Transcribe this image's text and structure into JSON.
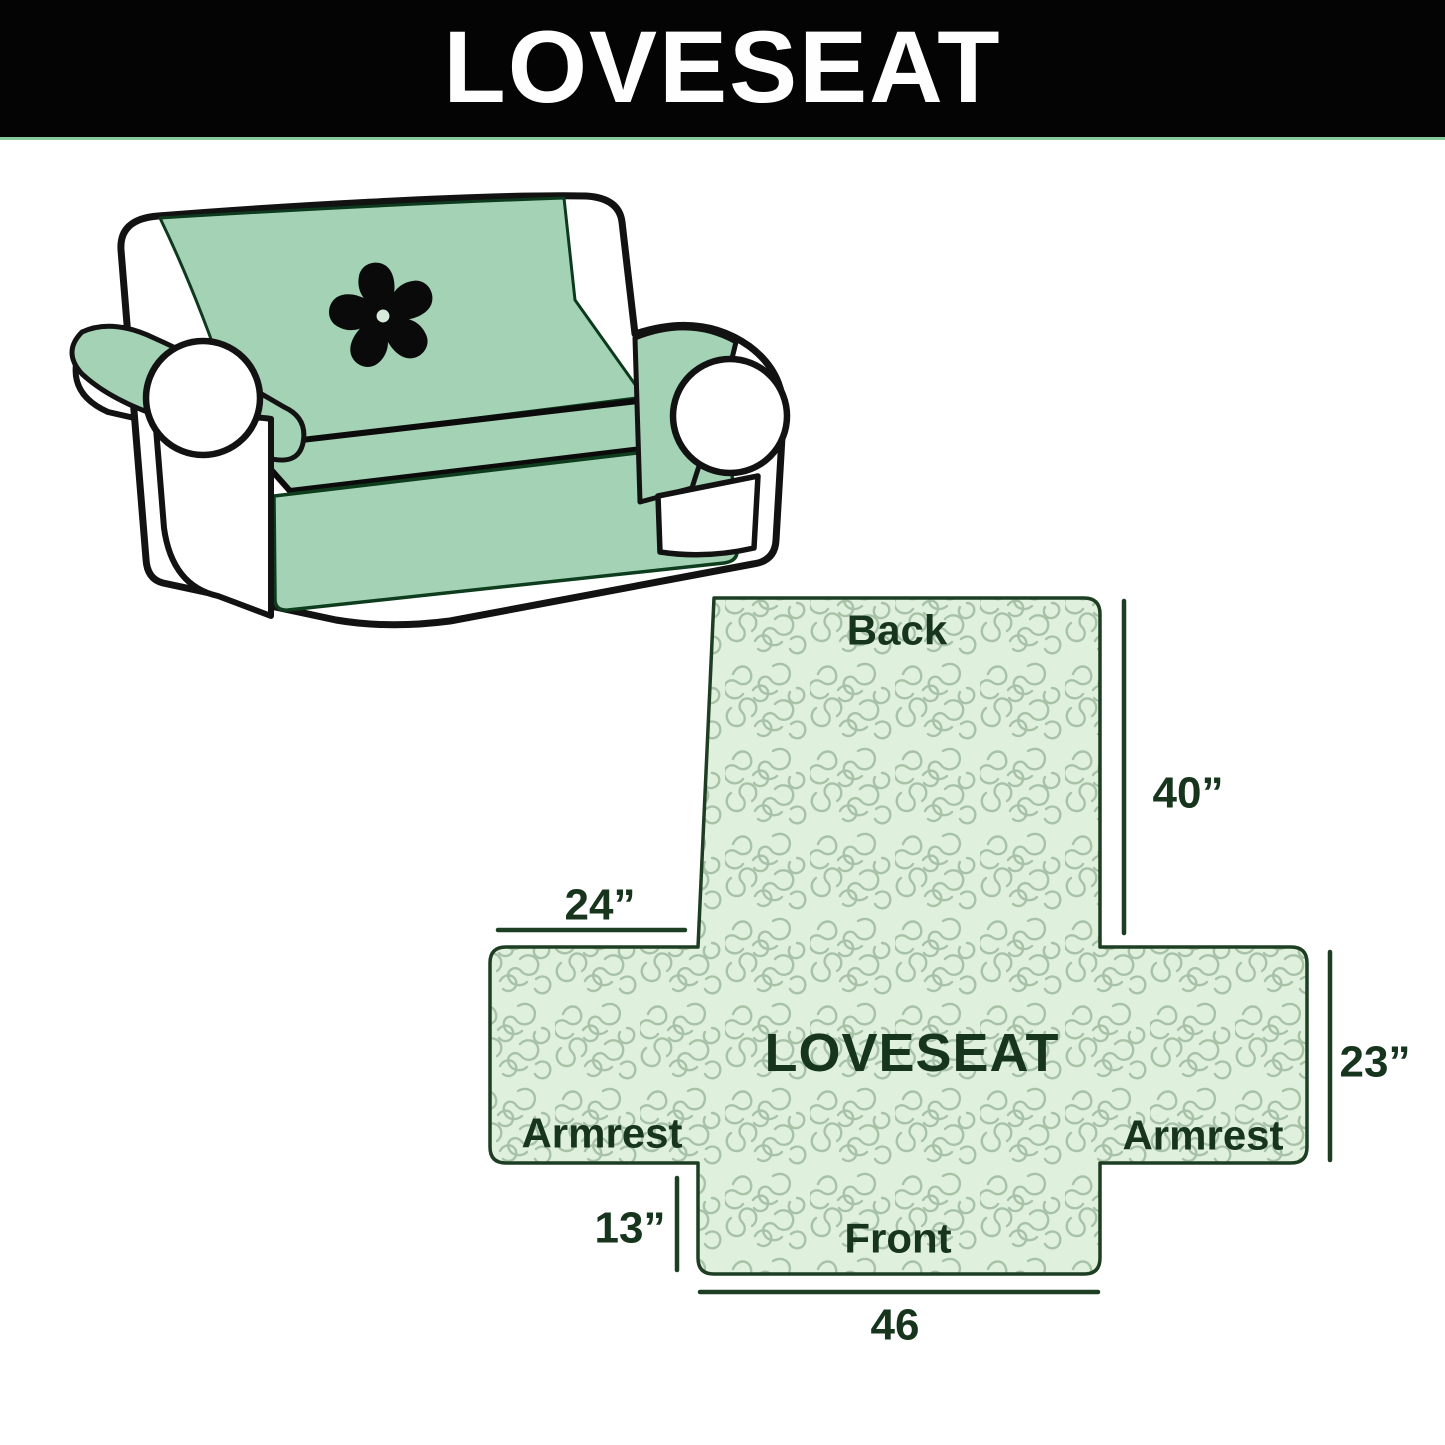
{
  "banner": {
    "title": "LOVESEAT"
  },
  "illustration": {
    "description": "loveseat sofa with quilted slipcover and pinwheel logo",
    "logo": "pinwheel-icon"
  },
  "diagram": {
    "center_label": "LOVESEAT",
    "sections": {
      "back": "Back",
      "front": "Front",
      "armrest_left": "Armrest",
      "armrest_right": "Armrest"
    },
    "dimensions": {
      "back_height": "40”",
      "armrest_top_width": "24”",
      "armrest_side_height": "23”",
      "front_drop_height": "13”",
      "front_width": "46"
    }
  },
  "colors": {
    "banner_bg": "#040404",
    "banner_text": "#fdfefd",
    "banner_underline": "#86c89b",
    "cover_green": "#a3d2b5",
    "sofa_outline": "#121212",
    "logo_black": "#0a0a0a",
    "diagram_fill": "#dff0dc",
    "diagram_pattern_line": "#a8c2a8",
    "diagram_outline": "#1d3e22",
    "diagram_text": "#16351c"
  }
}
